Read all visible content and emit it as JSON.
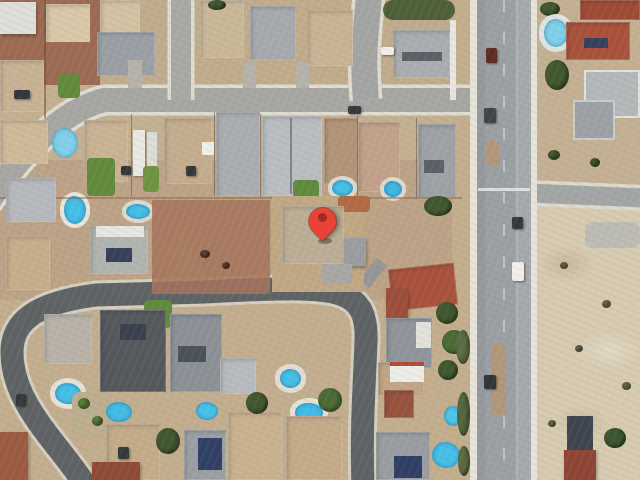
{
  "map": {
    "view": "satellite-imagery",
    "canvas": {
      "width": 640,
      "height": 480
    },
    "marker": {
      "tip_x": 322,
      "tip_y": 241
    }
  },
  "palette": {
    "base": "#c7b495",
    "dirt-red": "#9c6a52",
    "dirt-red-mid": "#a5735a",
    "desert-lot": "#d6cab0",
    "road-light": "#a6a6a2",
    "road-dark": "#5e6265",
    "arterial": "#9aa0a4",
    "curb": "#e6e3da",
    "median": "#b2967a",
    "pool-blue": "#44bfe7",
    "pool-pale": "#7fd0ea",
    "lawn": "#628a3c",
    "tree": "#40572f",
    "roof-gray": "#a2a6aa",
    "roof-silver": "#b9bdc1",
    "roof-dark": "#54585c",
    "roof-tan": "#c6b090",
    "roof-white": "#e8e6e0",
    "roof-red": "#a8523c",
    "roof-red-bright": "#9e4a36",
    "solar": "#35405c",
    "car-dark": "#33373b",
    "car-white": "#f0efe9",
    "pin-body": "#ea4335",
    "pin-dot": "#a02b20"
  },
  "features": {
    "roads": [
      "top-street",
      "northwest-stub-street",
      "upper-stub-street",
      "main-arterial-road",
      "east-side-road",
      "curving-residential-street"
    ],
    "areas": [
      "northwest-dirt-lots",
      "suburban-housing-blocks",
      "desert-vacant-lot",
      "marker-property"
    ],
    "landmarks": [
      "location-pin",
      "swimming-pools",
      "solar-panel-roofs",
      "red-tile-roofs",
      "parked-cars"
    ]
  }
}
